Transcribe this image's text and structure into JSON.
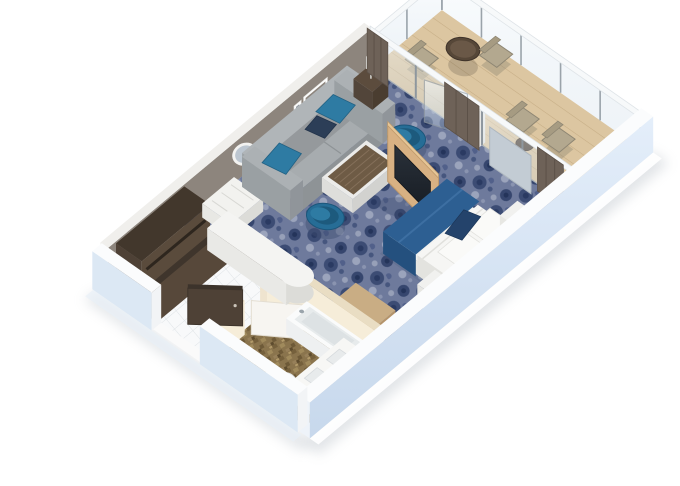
{
  "alt_text": "3D isometric cutaway floor plan of a cruise ship suite stateroom with living area, bedroom, bathroom, walk-in closet, entry and private balcony",
  "colors": {
    "carpet_base": "#6e7a9c",
    "carpet_dark": "#36466e",
    "carpet_light": "#9ba4bc",
    "accent_wall": "#8d857d",
    "wall_top": "#f0efec",
    "exterior_top": "#fbfcfd",
    "exterior_face_light": "#e4eefa",
    "exterior_face_dark": "#c7d8ec",
    "interior_white": "#f2f4f6",
    "sofa_top": "#a7acaf",
    "sofa_side": "#8e9396",
    "pillow_teal": "#2e7ba3",
    "pillow_navy": "#2c3e57",
    "chair_teal": "#266d96",
    "chair_seat": "#1d5a7d",
    "wood_light": "#d8b183",
    "wood_edge": "#c09a6b",
    "tv_screen_dark": "#161b22",
    "coffee_wood": "#6e5b45",
    "coffee_border": "#ebebe9",
    "bed_duvet": "#2d5f92",
    "bed_duvet_side": "#24507e",
    "bed_linen": "#f6f6f4",
    "balcony_floor": "#dcc6a1",
    "balcony_plank": "#c6ad85",
    "balcony_table": "#564738",
    "balcony_chair": "#b3a88f",
    "bath_floor": "#8a744d",
    "bath_wall": "#f6edd9",
    "bath_wall_top": "#e9ddc3",
    "tile_floor": "#f8f9fa",
    "tile_line": "#dfe3e6",
    "closet_dark": "#42372c",
    "closet_side": "#5a4b3c",
    "door_brown": "#4e4136",
    "curtain": "#6e6258",
    "glass_frame": "#9aa3aa",
    "fixture_white": "#fafbfb",
    "shadow": "#b6bdc5"
  },
  "rooms": [
    {
      "name": "living-area"
    },
    {
      "name": "bedroom-area"
    },
    {
      "name": "entryway"
    },
    {
      "name": "bathroom"
    },
    {
      "name": "wardrobe-closet"
    },
    {
      "name": "balcony"
    }
  ],
  "furniture": {
    "living": [
      "sofa",
      "throw-pillows",
      "armchair",
      "armchair",
      "coffee-table",
      "side-table",
      "table-lamp",
      "tv-cabinet",
      "wall-art",
      "round-mirror",
      "vanity-counter",
      "luggage-bench"
    ],
    "bedroom": [
      "double-bed",
      "blue-duvet",
      "pillows",
      "nightstand",
      "nightstand",
      "dresser",
      "full-length-mirror",
      "curtains"
    ],
    "bathroom": [
      "bathtub",
      "toilet",
      "double-sink-vanity",
      "bathroom-door"
    ],
    "balcony": [
      "round-dining-table",
      "dining-chairs",
      "lounge-chairs",
      "side-table",
      "glass-railing"
    ],
    "entry": [
      "entry-door",
      "wardrobe"
    ]
  }
}
